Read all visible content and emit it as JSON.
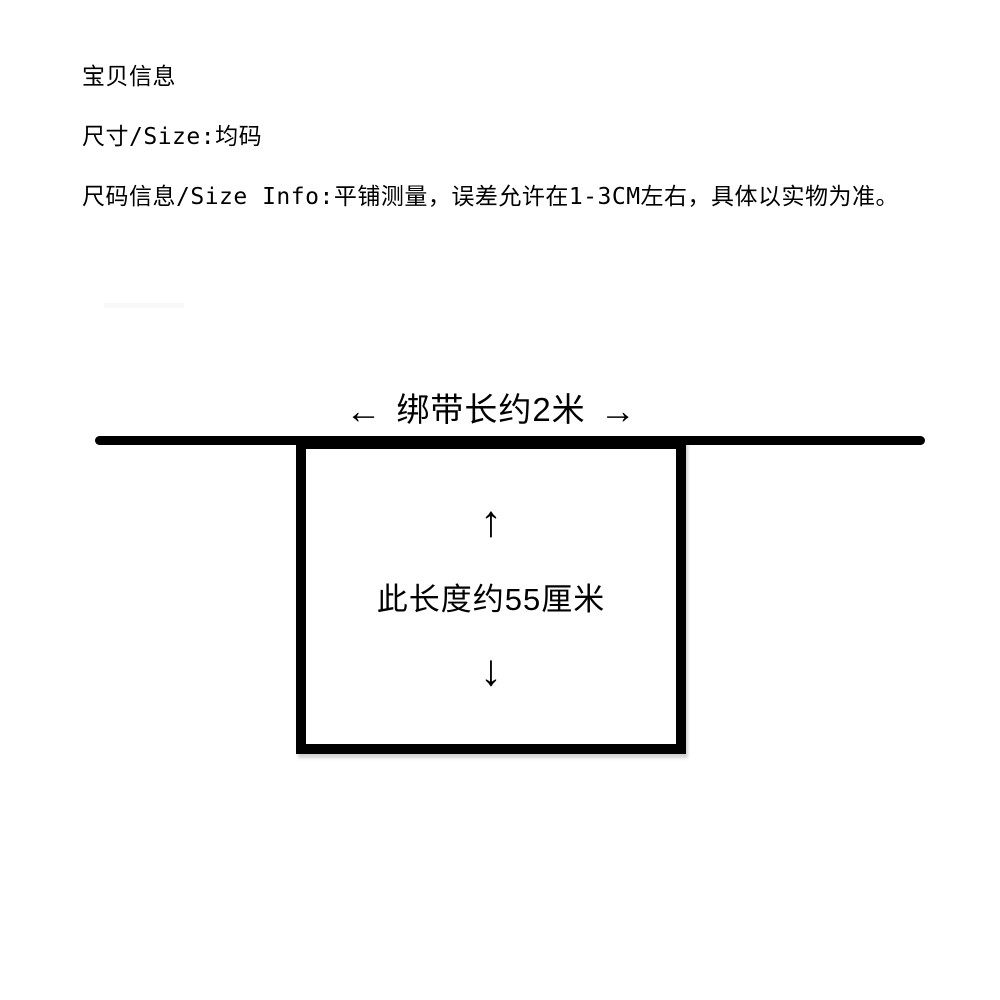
{
  "colors": {
    "background": "#ffffff",
    "ink": "#000000"
  },
  "info": {
    "title": "宝贝信息",
    "size_label": "尺寸/Size:均码",
    "size_info": "尺码信息/Size Info:平铺测量，误差允许在1-3CM左右，具体以实物为准。"
  },
  "diagram": {
    "strap_label": "绑带长约2米",
    "left_arrow": "←",
    "right_arrow": "→",
    "up_arrow": "↑",
    "down_arrow": "↓",
    "length_label": "此长度约55厘米"
  }
}
